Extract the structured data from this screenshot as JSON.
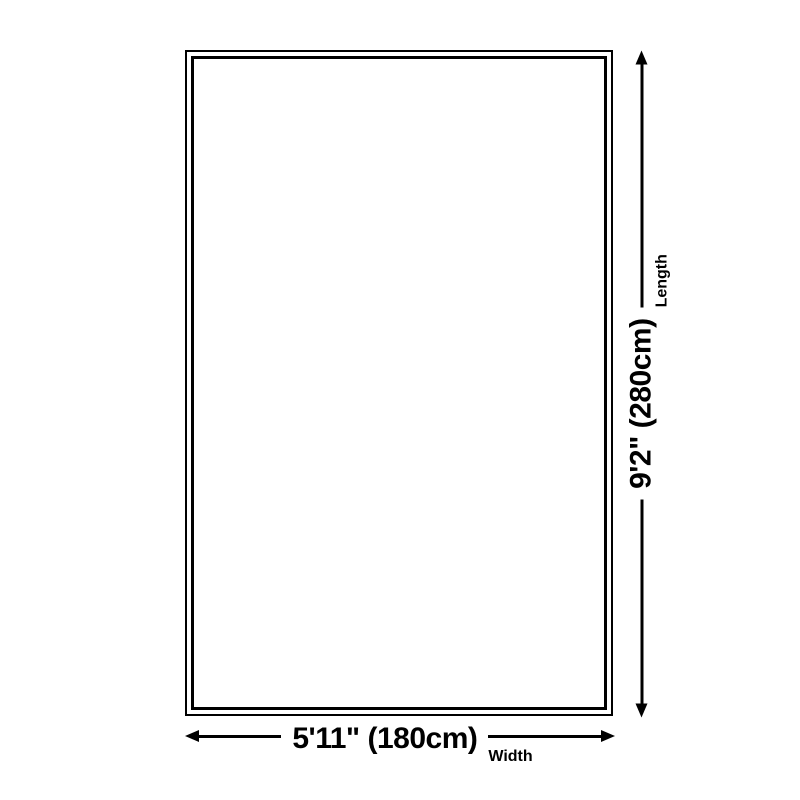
{
  "diagram": {
    "width": {
      "value": "5'11\" (180cm)",
      "axis_label": "Width"
    },
    "length": {
      "value": "9'2\" (280cm)",
      "axis_label": "Length"
    },
    "colors": {
      "line": "#000000",
      "background": "#ffffff"
    }
  }
}
